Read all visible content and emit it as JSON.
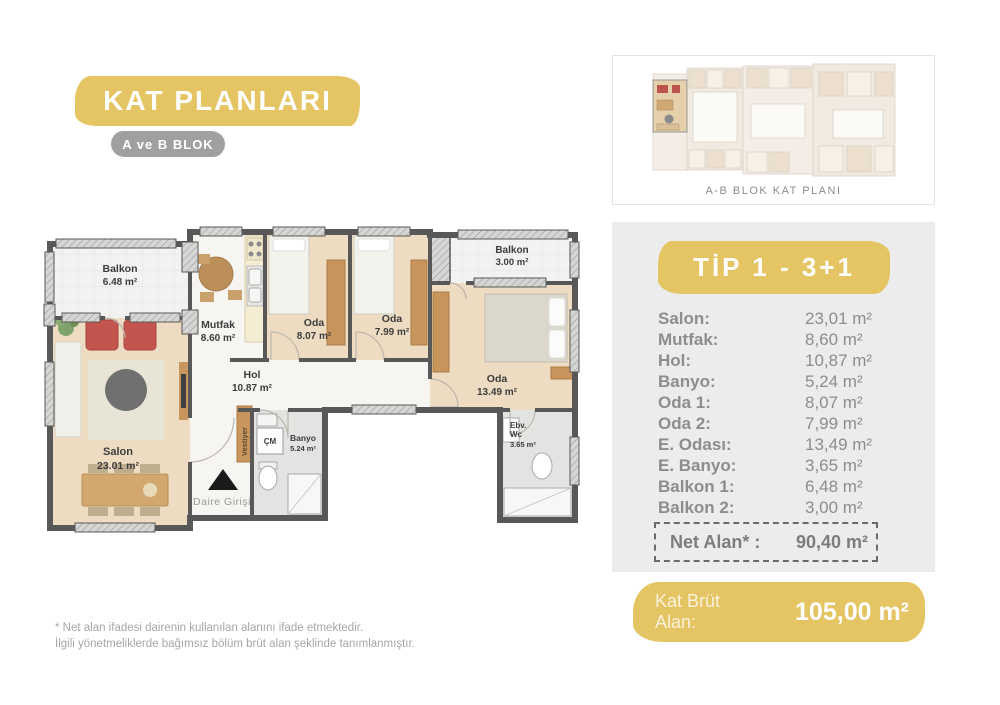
{
  "header": {
    "title": "KAT PLANLARI",
    "subtitle": "A ve B BLOK"
  },
  "overview": {
    "caption": "A-B BLOK KAT PLANI"
  },
  "plan": {
    "rooms": {
      "balkon1": {
        "name": "Balkon",
        "area": "6.48 m²"
      },
      "salon": {
        "name": "Salon",
        "area": "23.01 m²"
      },
      "mutfak": {
        "name": "Mutfak",
        "area": "8.60 m²"
      },
      "oda1": {
        "name": "Oda",
        "area": "8.07 m²"
      },
      "oda2": {
        "name": "Oda",
        "area": "7.99 m²"
      },
      "balkon2": {
        "name": "Balkon",
        "area": "3.00 m²"
      },
      "master": {
        "name": "Oda",
        "area": "13.49 m²"
      },
      "hol": {
        "name": "Hol",
        "area": "10.87 m²"
      },
      "banyo": {
        "name": "Banyo",
        "area": "5.24 m²"
      },
      "ebv_wc": {
        "name": "Ebv.",
        "name2": "Wc",
        "area": "3.65 m²"
      }
    },
    "labels": {
      "vestiyer": "Vestiyer",
      "cm": "ÇM",
      "entrance": "Daire Girişi"
    }
  },
  "details": {
    "type_title": "TİP 1 - 3+1",
    "rows": [
      {
        "label": "Salon:",
        "value": "23,01 m²"
      },
      {
        "label": "Mutfak:",
        "value": "8,60 m²"
      },
      {
        "label": "Hol:",
        "value": "10,87 m²"
      },
      {
        "label": "Banyo:",
        "value": "5,24 m²"
      },
      {
        "label": "Oda 1:",
        "value": "8,07 m²"
      },
      {
        "label": "Oda 2:",
        "value": "7,99 m²"
      },
      {
        "label": "E. Odası:",
        "value": "13,49 m²"
      },
      {
        "label": "E. Banyo:",
        "value": "3,65 m²"
      },
      {
        "label": "Balkon 1:",
        "value": "6,48 m²"
      },
      {
        "label": "Balkon 2:",
        "value": "3,00 m²"
      }
    ],
    "net": {
      "label": "Net Alan* :",
      "value": "90,40 m²"
    },
    "gross": {
      "label_line1": "Kat Brüt",
      "label_line2": "Alan:",
      "value": "105,00 m²"
    }
  },
  "footnote": {
    "line1": "* Net alan ifadesi dairenin kullanılan alanını ifade etmektedir.",
    "line2": "İlgili yönetmeliklerde bağımsız bölüm brüt alan şeklinde tanımlanmıştır."
  },
  "colors": {
    "accent_yellow": "#e4c463",
    "badge_gray": "#a0a0a0",
    "panel_gray": "#ececec",
    "wall_gray": "#585858",
    "floor_beige": "#eedcc2",
    "wardrobe_wood": "#c8965c",
    "armchair_red": "#c4544e"
  }
}
